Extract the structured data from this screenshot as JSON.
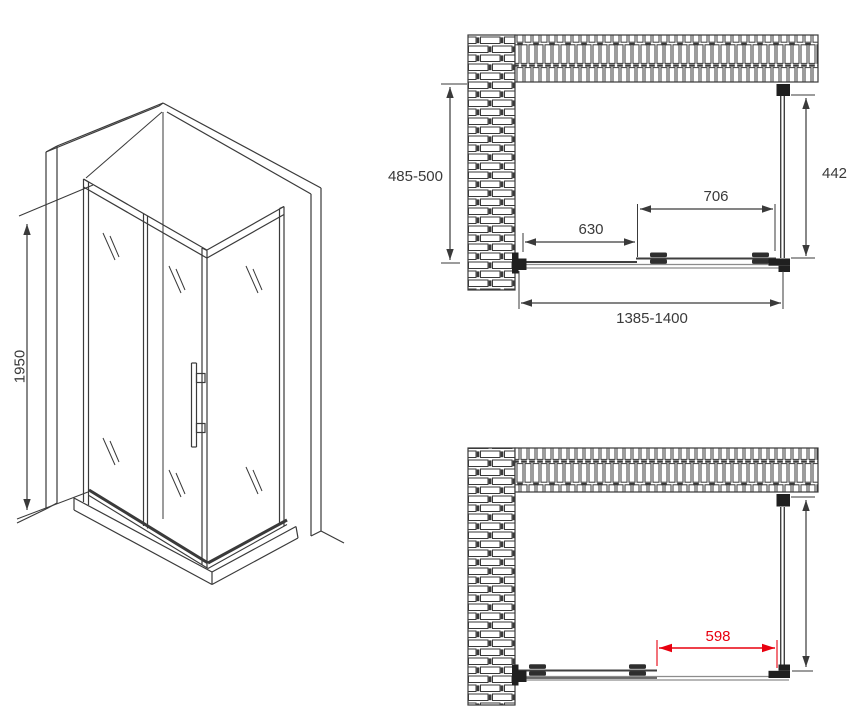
{
  "drawing": {
    "kind": "shower-enclosure-installation-drawing",
    "views": {
      "isometric": {
        "height_dim": "1950"
      },
      "plan_closed": {
        "depth_dim": "485-500",
        "side_glass_dim": "442",
        "door_dim": "706",
        "fixed_panel_dim": "630",
        "overall_width_dim": "1385-1400"
      },
      "plan_open": {
        "opening_dim": "598"
      }
    }
  },
  "colors": {
    "line": "#3a3a3a",
    "glass_line": "#3f3f3f",
    "track_line": "#8c8c8c",
    "highlight": "#e8000f",
    "background": "#ffffff"
  }
}
